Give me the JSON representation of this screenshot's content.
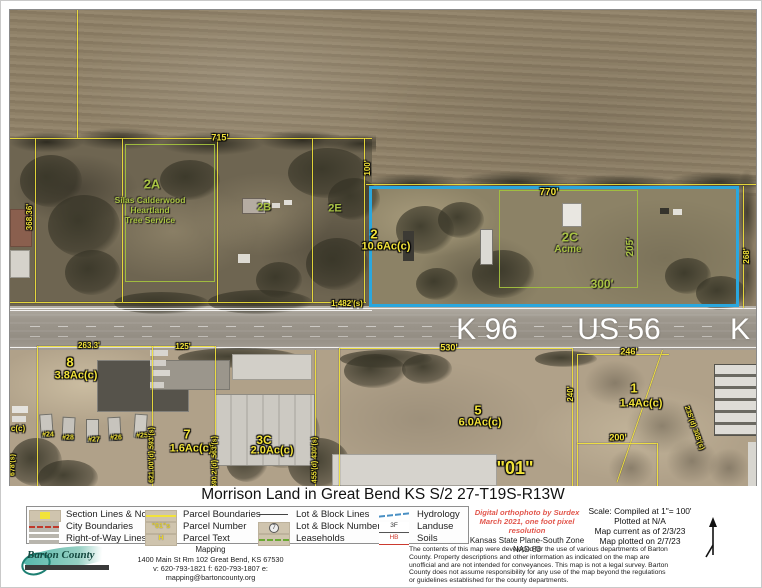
{
  "title": "Morrison Land in Great Bend KS S/2 27-T19S-R13W",
  "colors": {
    "parcel_line_yellow": "#f2e33a",
    "leasehold_green": "#a8c244",
    "highlight_blue": "#2aa7de",
    "road_label_white": "#ffffff"
  },
  "map": {
    "road_labels": {
      "k96": "K 96",
      "us56": "US 56",
      "k": "K"
    },
    "parcels": {
      "p2a": {
        "id": "2A",
        "line1": "Silas Calderwood",
        "line2": "Heartland",
        "line3": "Tree Service"
      },
      "p2b": {
        "id": "2B"
      },
      "p2e": {
        "id": "2E"
      },
      "p2": {
        "id": "2",
        "area": "10.6Ac(c)"
      },
      "p2c": {
        "id": "2C",
        "name": "Acme"
      },
      "p8": {
        "id": "8",
        "area": "3.8Ac(c)"
      },
      "p7": {
        "id": "7",
        "area": "1.6Ac(c)"
      },
      "p3c": {
        "id": "3C",
        "area": "2.0Ac(c)"
      },
      "p5": {
        "id": "5",
        "area": "6.0Ac(c)"
      },
      "p1": {
        "id": "1",
        "area": "1.4Ac(c)"
      },
      "block01": "\"01\""
    },
    "dimensions": {
      "d715": "715'",
      "d368": "368.36'",
      "d100": "100'",
      "d770": "770'",
      "d205": "205'",
      "d300": "300'",
      "d268": "268'",
      "d1482": "1,482'(s)",
      "d530": "530'",
      "d246": "246'",
      "d263": "263.3'",
      "d125": "125'",
      "d621": "621.00'(d) 593'(s)",
      "d590": "590.2'(d) 563'(s)",
      "d678": "678'(s)",
      "d455": "455'(d) 430'(s)",
      "d200": "200'",
      "d240": "240'",
      "d308": "235'(d) 308'(s)",
      "dcc": "c(c)"
    },
    "trailer_numbers": [
      "#24",
      "#28",
      "#27",
      "#26",
      "#25"
    ]
  },
  "legend": {
    "groups": [
      {
        "items": [
          "Section Lines & No.",
          "City Boundaries",
          "Right-of-Way Lines"
        ]
      },
      {
        "items": [
          "Parcel Boundaries",
          "Parcel Number",
          "Parcel Text"
        ]
      },
      {
        "items": [
          "Lot & Block Lines",
          "Lot & Block Numbers",
          "Leaseholds"
        ]
      },
      {
        "items": [
          "Hydrology",
          "Landuse",
          "Soils"
        ]
      }
    ],
    "glyphs": {
      "parcel_number": "\"01\"s",
      "parcel_text": "H",
      "lot_block_number": "7",
      "landuse": "3F",
      "soils": "HB"
    }
  },
  "footer": {
    "logo_text": "Barton County",
    "dept": "Mapping",
    "address": "1400 Main St Rm 102 Great Bend, KS  67530",
    "contact": "v: 620-793-1821  f: 620-793-1807  e: mapping@bartoncounty.org",
    "ortho1": "Digital orthophoto by Surdex",
    "ortho2": "March 2021, one foot pixel resolution",
    "proj1": "Kansas State Plane-South Zone",
    "proj2": "NAD 83",
    "scale1": "Scale:  Compiled at 1\"= 100'",
    "scale2": "Plotted at N/A",
    "scale3": "Map current as of 2/3/23",
    "scale4": "Map plotted on 2/7/23",
    "disclaimer": "The contents of this map were developed for the use of various departments of Barton County. Property descriptions and other information as indicated on the map are unofficial and are not intended for conveyances. This map is not a legal survey. Barton County does not assume responsibility for any use of the map beyond the regulations or guidelines established for the county departments."
  }
}
